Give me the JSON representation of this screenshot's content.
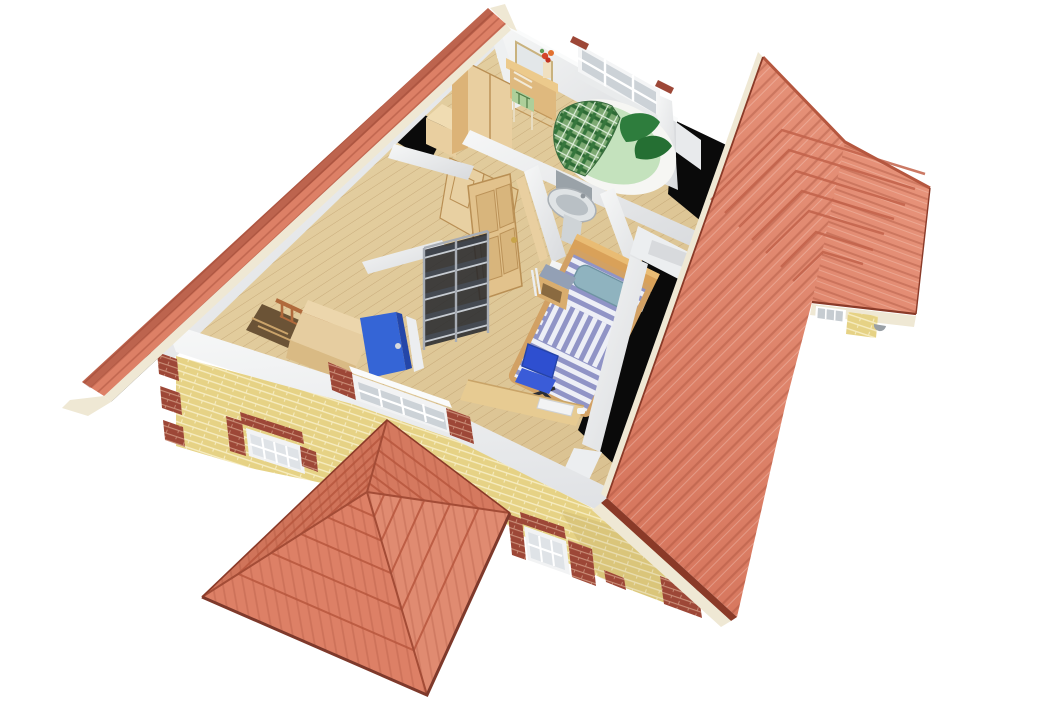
{
  "meta": {
    "description": "3D cutaway dollhouse render of a house upper floor with furnished rooms, yellow brick facade and terracotta tiled roofs",
    "render_type": "architectural-cutaway"
  },
  "palette": {
    "background": "#ffffff",
    "roof_tile": "#dd8066",
    "roof_tile_shadow": "#c66b52",
    "roof_ridge": "#8a3a28",
    "fascia": "#efe8d4",
    "brick_yellow": "#e6d285",
    "brick_red": "#9d4737",
    "wall_white": "#f2f3f4",
    "wall_shade": "#d9dbde",
    "floor_wood": "#e8d4a6",
    "void_black": "#0a0a0a",
    "wood_light": "#e9cfa0",
    "wood_mid": "#dcb377",
    "wood_dark": "#b98f54",
    "glass": "#ccd2d7",
    "door_blue": "#3565d6",
    "chair_blue": "#2e4fd0",
    "bed_green": "#c4e2bd",
    "blanket_green": "#2e6b35",
    "pillow_green": "#2e7d3d",
    "bed_stripe_blue": "#9094c6",
    "pillow_teal": "#8fb3bf",
    "metal_grey": "#a8adb5",
    "shelf_dark": "#40454d",
    "stair_wood": "#b06a3c"
  },
  "scene": {
    "rooms": [
      {
        "name": "bedroom-green",
        "furniture": [
          "round-bed",
          "plaid-blanket",
          "green-pillows",
          "dressing-table",
          "mirror",
          "dining-chair",
          "flower-vase",
          "rear-window"
        ]
      },
      {
        "name": "closet-room",
        "furniture": [
          "wardrobe",
          "under-eaves-cabinet",
          "open-panel-doors"
        ]
      },
      {
        "name": "bathroom",
        "furniture": [
          "pedestal-sink"
        ]
      },
      {
        "name": "landing",
        "furniture": [
          "staircase",
          "stair-railing",
          "stairwell-enclosure",
          "blue-door",
          "panel-door"
        ]
      },
      {
        "name": "bedroom-striped",
        "furniture": [
          "striped-bed",
          "headboard",
          "pillow",
          "nightstand",
          "office-chair",
          "desk",
          "keyboard",
          "metal-shelving-unit"
        ]
      }
    ],
    "exterior": [
      "left-roof-edge",
      "main-front-roof-slope",
      "right-roof-wing",
      "front-hip-roof",
      "yellow-brick-facade",
      "red-brick-quoins",
      "facade-windows",
      "sectioned-window",
      "dormer-window",
      "attic-voids"
    ]
  }
}
